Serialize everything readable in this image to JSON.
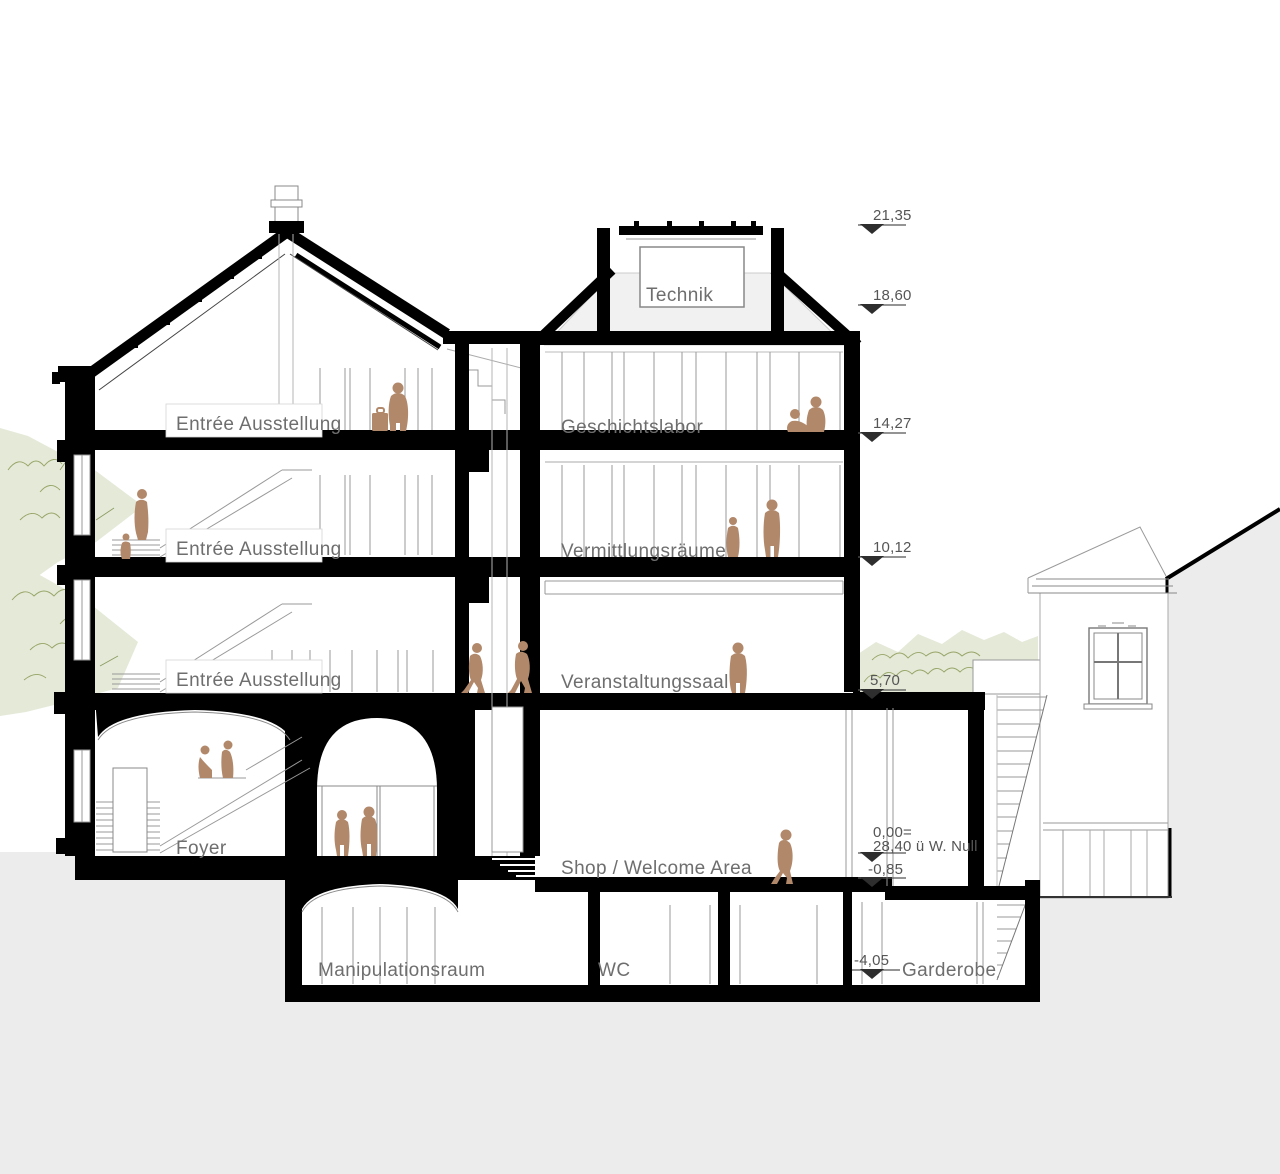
{
  "rooms": {
    "technik": "Technik",
    "geschichtslabor": "Geschichtslabor",
    "entree_top": "Entrée Ausstellung",
    "entree_mid": "Entrée Ausstellung",
    "entree_low": "Entrée Ausstellung",
    "vermittlungsraeume": "Vermittlungsräume",
    "veranstaltungssaal": "Veranstaltungssaal",
    "foyer": "Foyer",
    "shop": "Shop / Welcome Area",
    "manipulationsraum": "Manipulationsraum",
    "wc": "WC",
    "garderobe": "Garderobe"
  },
  "levels": {
    "l2135": "21,35",
    "l1860": "18,60",
    "l1427": "14,27",
    "l1012": "10,12",
    "l570": "5,70",
    "l000": "0,00=",
    "l000_note": "28,40 ü W. Null",
    "l085": "-0,85",
    "l405": "-4,05"
  },
  "colors": {
    "figure": "#b1886a",
    "ground": "#ececec",
    "foliage_fill": "#e4e9d8",
    "foliage_stroke": "#96a466",
    "label_text": "#6e6e6e",
    "level_text": "#555555",
    "ink": "#000000"
  }
}
